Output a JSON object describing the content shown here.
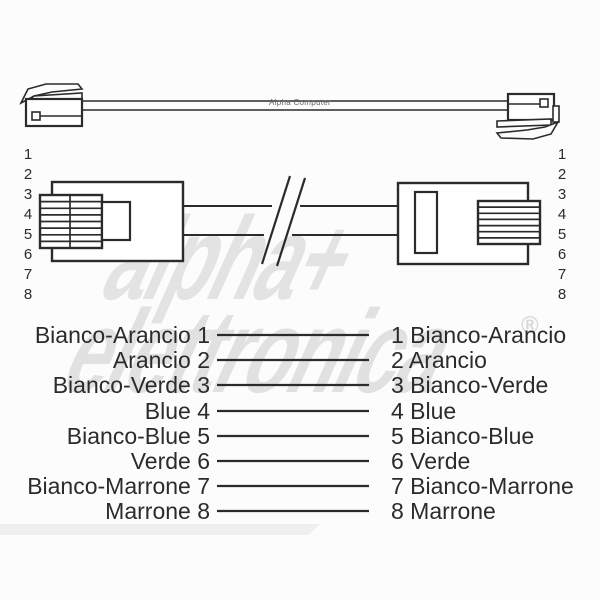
{
  "watermark": {
    "word1": "alpha+",
    "word2": "elettronica",
    "registered": "®"
  },
  "cable": {
    "brand_label": "Alpha Computer"
  },
  "connectors": {
    "pin_numbers": [
      "1",
      "2",
      "3",
      "4",
      "5",
      "6",
      "7",
      "8"
    ]
  },
  "wiring": {
    "rows": [
      {
        "left_label": "Bianco-Arancio 1",
        "right_label": "1 Bianco-Arancio"
      },
      {
        "left_label": "Arancio 2",
        "right_label": "2 Arancio"
      },
      {
        "left_label": "Bianco-Verde 3",
        "right_label": "3 Bianco-Verde"
      },
      {
        "left_label": "Blue 4",
        "right_label": "4 Blue"
      },
      {
        "left_label": "Bianco-Blue 5",
        "right_label": "5 Bianco-Blue"
      },
      {
        "left_label": "Verde 6",
        "right_label": "6 Verde"
      },
      {
        "left_label": "Bianco-Marrone 7",
        "right_label": "7 Bianco-Marrone"
      },
      {
        "left_label": "Marrone 8",
        "right_label": "8 Marrone"
      }
    ]
  },
  "colors": {
    "line": "#2b2b2b",
    "watermark": "#e3e3e3",
    "background": "#fcfcfc"
  }
}
